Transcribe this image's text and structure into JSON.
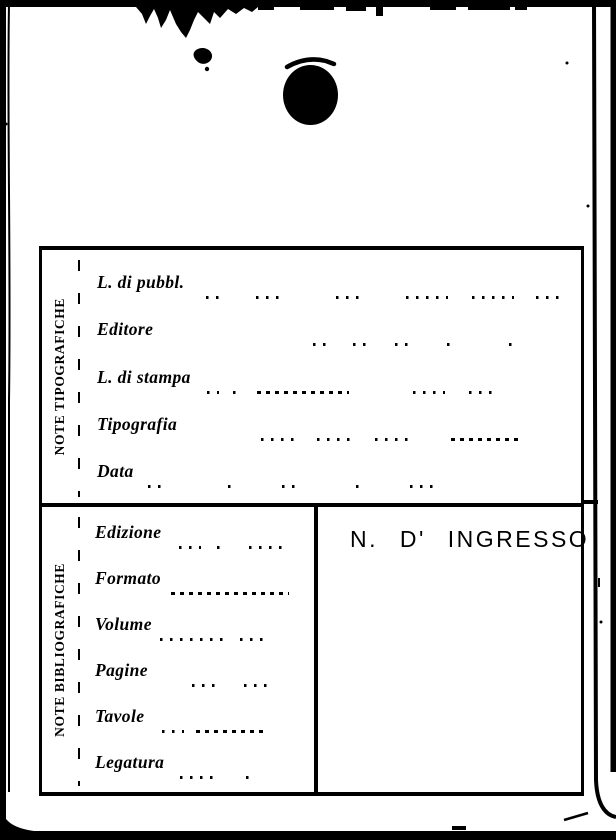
{
  "page": {
    "kind": "scanned library catalog card",
    "paper_color": "#ffffff",
    "ink_color": "#000000"
  },
  "typographic_notes": {
    "title": "NOTE TIPOGRAFICHE",
    "fields": [
      "L. di pubbl.",
      "Editore",
      "L. di stampa",
      "Tipografia",
      "Data"
    ]
  },
  "bibliographic_notes": {
    "title": "NOTE BIBLIOGRAFICHE",
    "fields": [
      "Edizione",
      "Formato",
      "Volume",
      "Pagine",
      "Tavole",
      "Legatura"
    ]
  },
  "accession": {
    "label": "N. D' INGRESSO"
  }
}
